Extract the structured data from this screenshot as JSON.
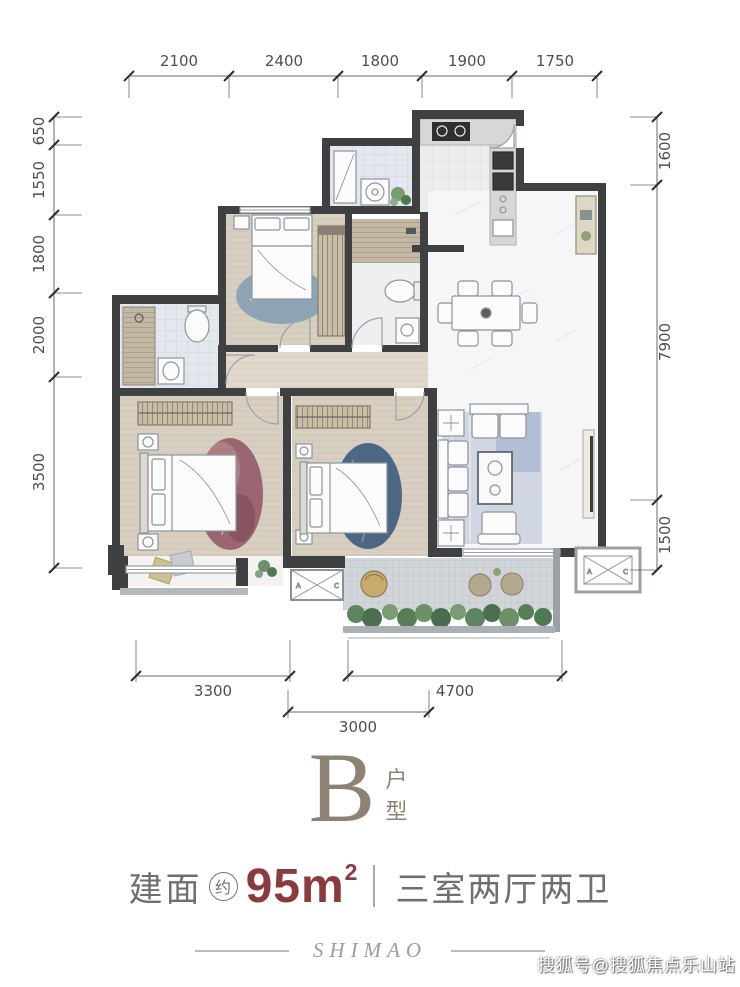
{
  "dims": {
    "top": [
      "2100",
      "2400",
      "1800",
      "1900",
      "1750"
    ],
    "left": [
      "650",
      "1550",
      "1800",
      "2000",
      "3500"
    ],
    "right": [
      "1600",
      "7900",
      "1500"
    ],
    "bottom": [
      "3300",
      "4700"
    ],
    "bottom2": [
      "3000"
    ]
  },
  "plan": {
    "ac_mark_a": "A",
    "ac_mark_c": "C"
  },
  "footer": {
    "unit": "B",
    "unit_suffix": "户型",
    "area_label": "建面",
    "area_approx": "约",
    "area_value": "95m",
    "area_exp": "2",
    "layout": "三室两厅两卫",
    "brand": "SHIMAO",
    "watermark": "搜狐号@搜狐焦点乐山站"
  },
  "colors": {
    "accent_red": "#8b3a3e",
    "brand_taupe": "#8e8372",
    "wall": "#3f4042",
    "text_gray": "#6f6f6f"
  }
}
